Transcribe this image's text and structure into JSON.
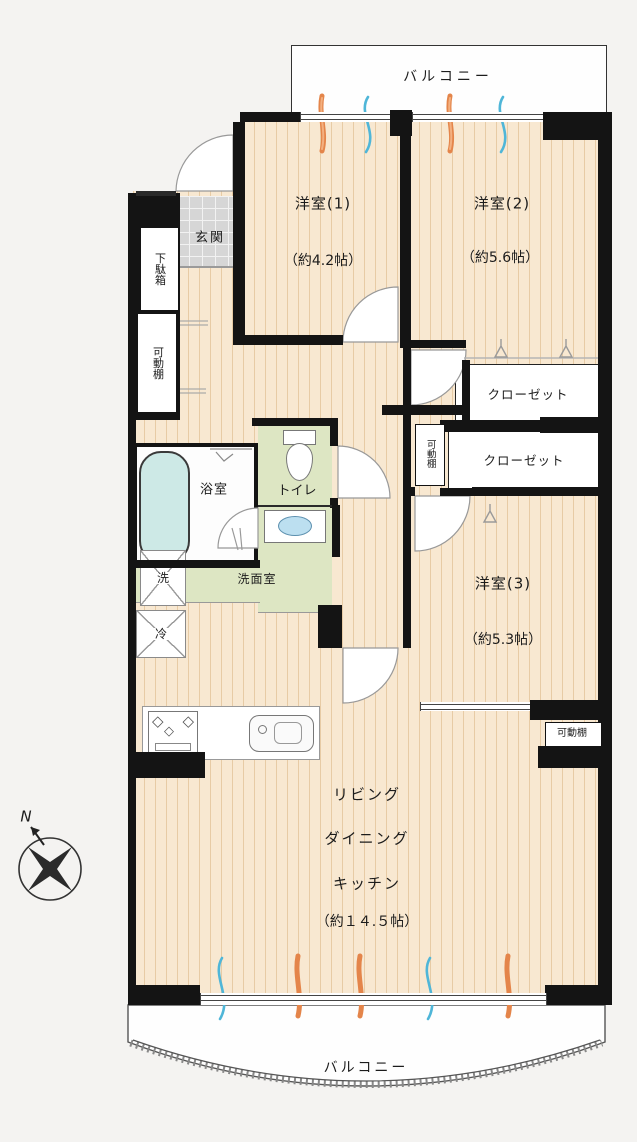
{
  "floorplan": {
    "balcony_top": "バルコニー",
    "balcony_bottom": "バルコニー",
    "compass": {
      "label": "N"
    },
    "rooms": {
      "yoshitsu1": {
        "name": "洋室(1)",
        "size": "（約4.2帖）"
      },
      "yoshitsu2": {
        "name": "洋室(2)",
        "size": "（約5.6帖）"
      },
      "yoshitsu3": {
        "name": "洋室(3)",
        "size": "（約5.3帖）"
      },
      "ldk": {
        "line1": "リビング",
        "line2": "ダイニング",
        "line3": "キッチン",
        "line4": "（約１４.５帖）"
      },
      "genkan": "玄関",
      "getabako": "下駄箱",
      "kadoudana_left": "可動棚",
      "kadoudana_mid": "可動棚",
      "kadoudana_right": "可動棚",
      "closet1": "クローゼット",
      "closet2": "クローゼット",
      "bath": "浴室",
      "toilet": "トイレ",
      "washroom": "洗面室",
      "washer": "洗",
      "fridge": "冷"
    },
    "colors": {
      "wall": "#141414",
      "floor": "#f8e8d1",
      "wet_area_green": "#dde6c3",
      "entry_tile": "#d6d6d6",
      "bathtub": "#cde9e6",
      "sun_mark_orange": "#e4854a",
      "wind_mark_blue": "#4fb6d8",
      "background": "#f4f3f1"
    }
  }
}
